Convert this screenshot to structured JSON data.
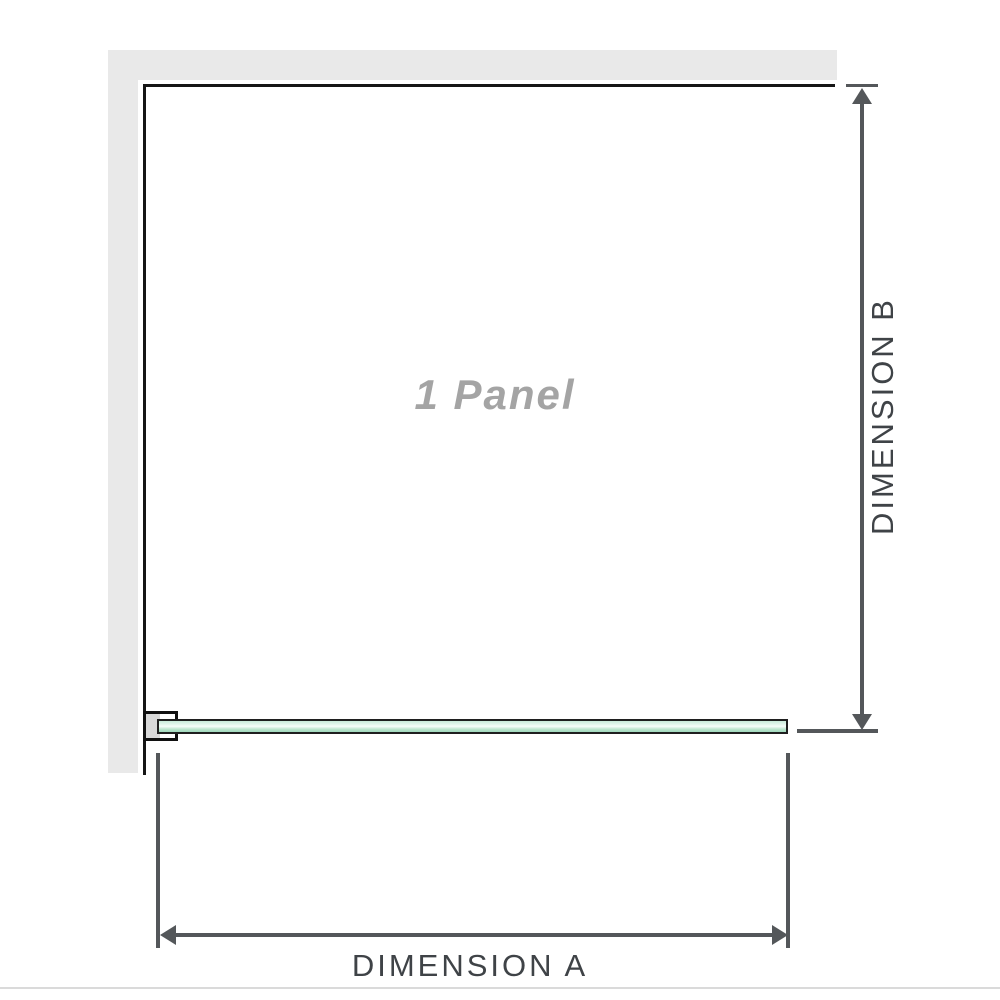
{
  "diagram": {
    "panel_label": "1 Panel",
    "dimension_a_label": "DIMENSION A",
    "dimension_b_label": "DIMENSION B"
  },
  "colors": {
    "background": "#ffffff",
    "wall_fill": "#e9e9e9",
    "edge_line": "#161616",
    "dimension_line": "#54575a",
    "dimension_text": "#3f4347",
    "panel_label_text": "#a4a4a4",
    "glass_border": "#1f1f1f",
    "glass_green_light": "#e3f6ec",
    "glass_green": "#a0d9bd",
    "bracket_fill": "#d8d8d8",
    "bottom_rule": "#dadada"
  }
}
